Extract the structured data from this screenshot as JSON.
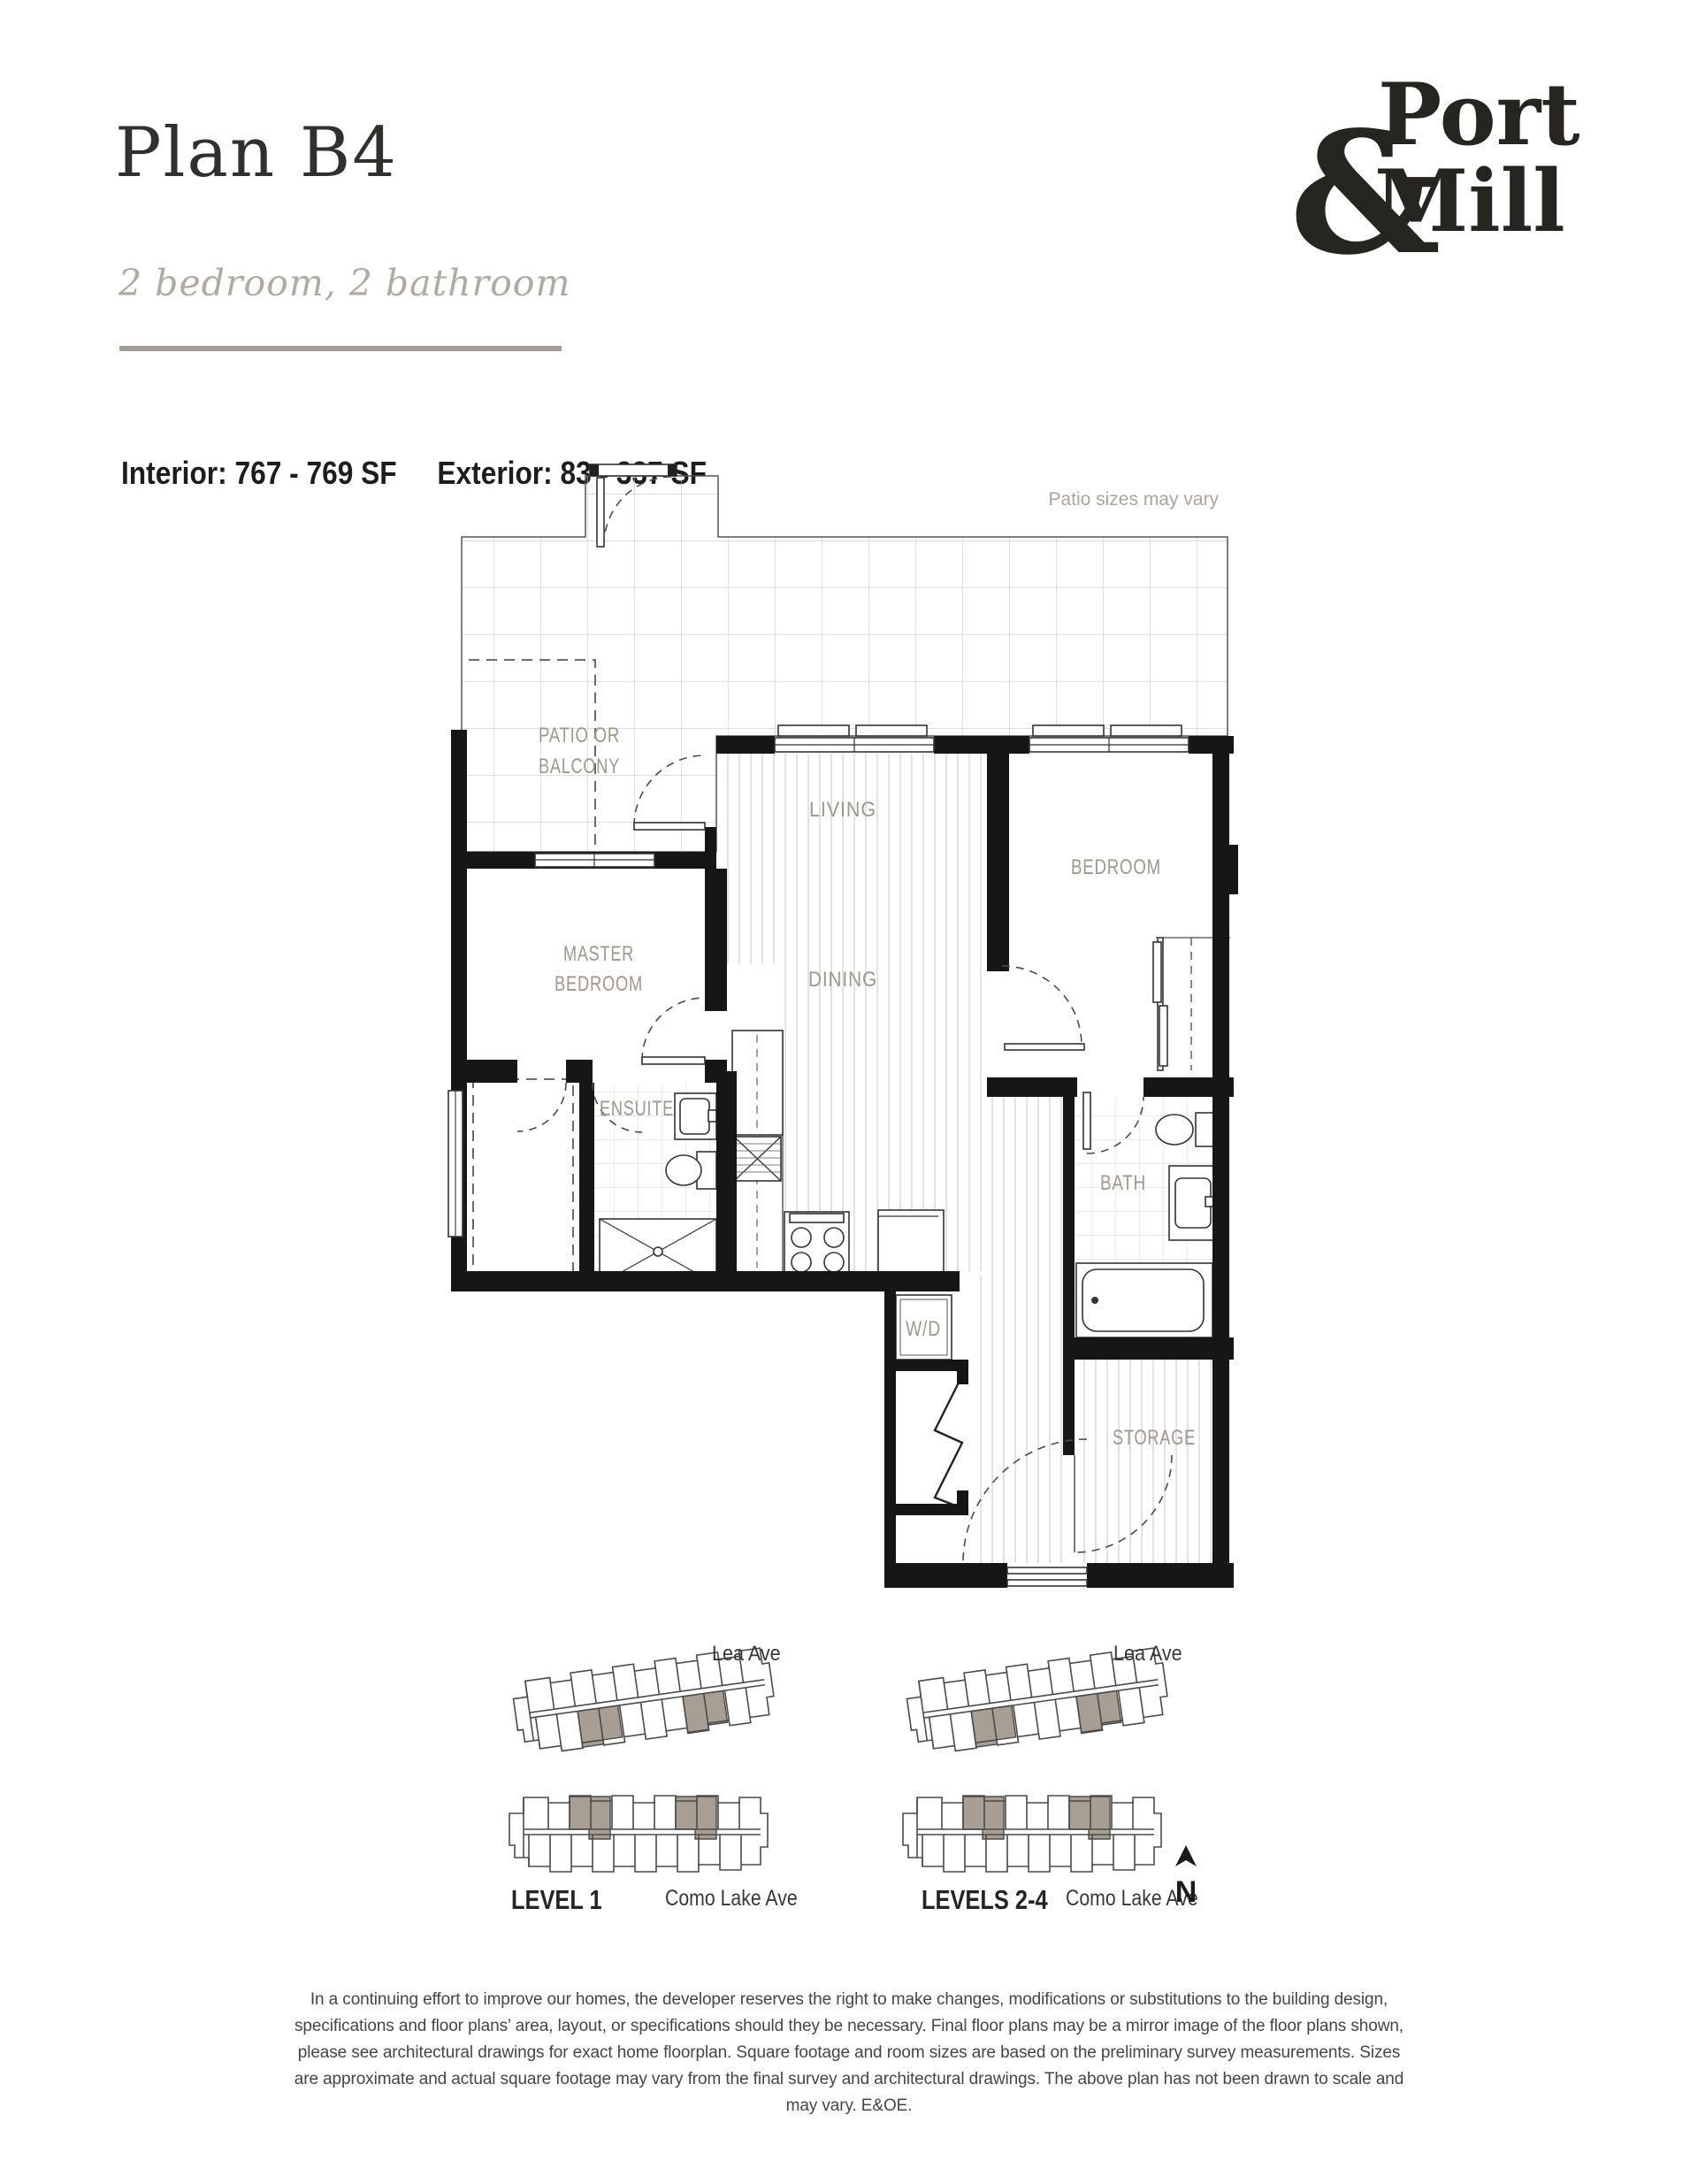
{
  "header": {
    "title": "Plan B4",
    "subtitle": "2 bedroom, 2 bathroom",
    "interior": "Interior: 767 - 769 SF",
    "exterior": "Exterior: 83 - 337 SF"
  },
  "logo": {
    "word1": "Port",
    "ampersand": "&",
    "word2": "Mill"
  },
  "plan": {
    "note": "Patio sizes may vary",
    "patio1": "PATIO OR",
    "patio2": "BALCONY",
    "living": "LIVING",
    "dining": "DINING",
    "bedroom": "BEDROOM",
    "master1": "MASTER",
    "master2": "BEDROOM",
    "ensuite": "ENSUITE",
    "bath": "BATH",
    "wd": "W/D",
    "storage": "STORAGE"
  },
  "keyplan": {
    "lea_left": "Lea Ave",
    "lea_right": "Lea Ave",
    "level_left": "LEVEL 1",
    "level_right": "LEVELS 2-4",
    "como_left": "Como Lake Ave",
    "como_right": "Como Lake Ave",
    "north": "N",
    "highlight": "#a89e93"
  },
  "disclaimer": "In a continuing effort to improve our homes, the developer reserves the right to make changes, modifications or substitutions to the building design, specifications and floor plans’ area, layout, or specifications should they be necessary. Final floor plans may be a mirror image of the floor plans shown, please see architectural drawings for exact home floorplan. Square footage and room sizes are based on the preliminary survey measurements. Sizes are approximate and actual square footage may vary from the final survey and architectural drawings. The above plan has not been drawn to scale and may vary. E&OE."
}
